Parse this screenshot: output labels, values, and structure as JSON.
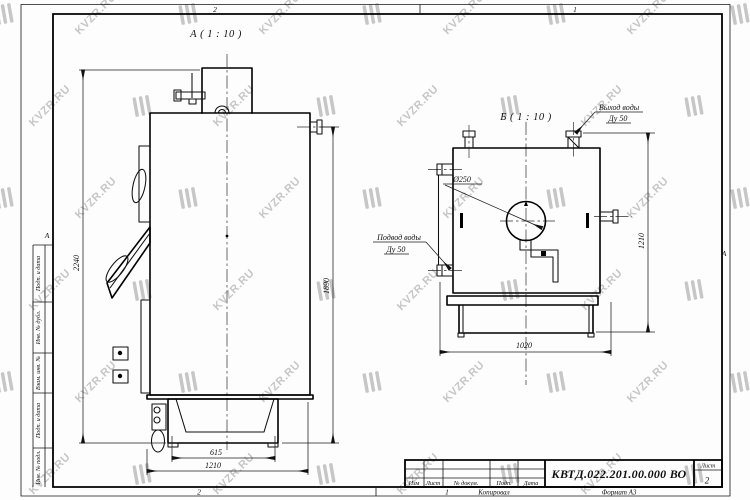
{
  "watermark": {
    "text": "KVZR.RU",
    "color": "#c6c6c6"
  },
  "frame": {
    "zones_top": [
      "2",
      "1"
    ],
    "zones_bottom": [
      "2",
      "1"
    ],
    "zone_left": "А",
    "zone_right": "А",
    "footer_copied": "Копировал",
    "footer_format": "Формат А3",
    "side_columns": [
      "Подп. и дата",
      "Инв. № дубл.",
      "Взам. инв. №",
      "Подп. и дата",
      "Инв. № подл."
    ]
  },
  "title_block": {
    "doc_number": "КВТД.022.201.00.000 ВО",
    "columns": [
      "Изм",
      "Лист",
      "№ докум.",
      "Подп.",
      "Дата"
    ],
    "sheet_label": "Лист",
    "sheet_value": "2"
  },
  "view_a": {
    "label": "А ( 1 : 10 )",
    "dim_total_height": "2240",
    "dim_outlet_height": "1890",
    "dim_base": "615",
    "dim_depth": "1210"
  },
  "view_b": {
    "label": "Б ( 1 : 10 )",
    "dim_width": "1020",
    "dim_height": "1210",
    "flue_dia": "Ø250",
    "outlet_line1": "Выход воды",
    "outlet_line2": "Ду 50",
    "inlet_line1": "Подвод воды",
    "inlet_line2": "Ду 50"
  }
}
